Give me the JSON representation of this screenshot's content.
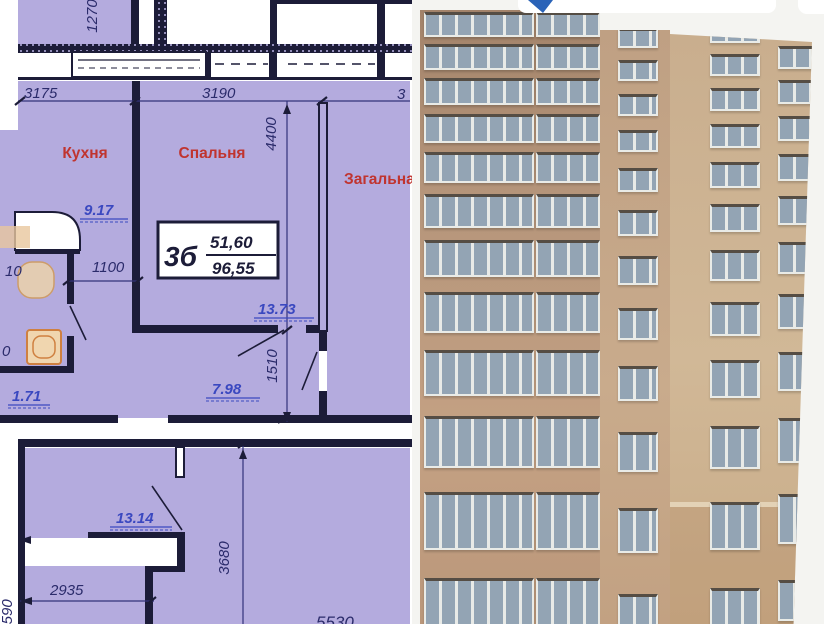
{
  "plan": {
    "labels": {
      "kitchen": "Кухня",
      "bedroom": "Спальня",
      "living": "Загальна"
    },
    "areas": {
      "kitchen": "9.17",
      "corridor": "13.73",
      "hall": "7.98",
      "bath": "1.71",
      "lower_room": "13.14"
    },
    "unit_box": {
      "unit": "3б",
      "living_area": "51,60",
      "total_area": "96,55"
    },
    "dims": {
      "v_1270": "1270",
      "w_3175": "3175",
      "w_3190": "3190",
      "w_right_partial": "3",
      "v_4400": "4400",
      "w_1100": "1100",
      "left_partial_a": "10",
      "left_partial_b": "0",
      "v_1510": "1510",
      "v_3680": "3680",
      "w_2935": "2935",
      "v_1590": "1590",
      "w_5530": "5530"
    },
    "colors": {
      "room_fill": "#b4abde",
      "wall": "#1c1c38",
      "label_red": "#c0342f",
      "dim_navy": "#2b2b6b",
      "area_blue": "#3a48c0",
      "fixture_orange": "#cf8040",
      "fixture_fill": "#f0d6af"
    }
  },
  "photo": {
    "icons": {
      "logo_arrow": "cursor-arrow"
    },
    "colors": {
      "sky": "#f4f4f1",
      "facade_left": "#b5957a",
      "facade_middle": "#c9ab8c",
      "facade_right": "#d1b897",
      "window_glass": "#93a4b4",
      "window_frame": "#e9ebe7",
      "watermark_bar": "#ffffff",
      "logo_arrow": "#2a63b8"
    }
  }
}
